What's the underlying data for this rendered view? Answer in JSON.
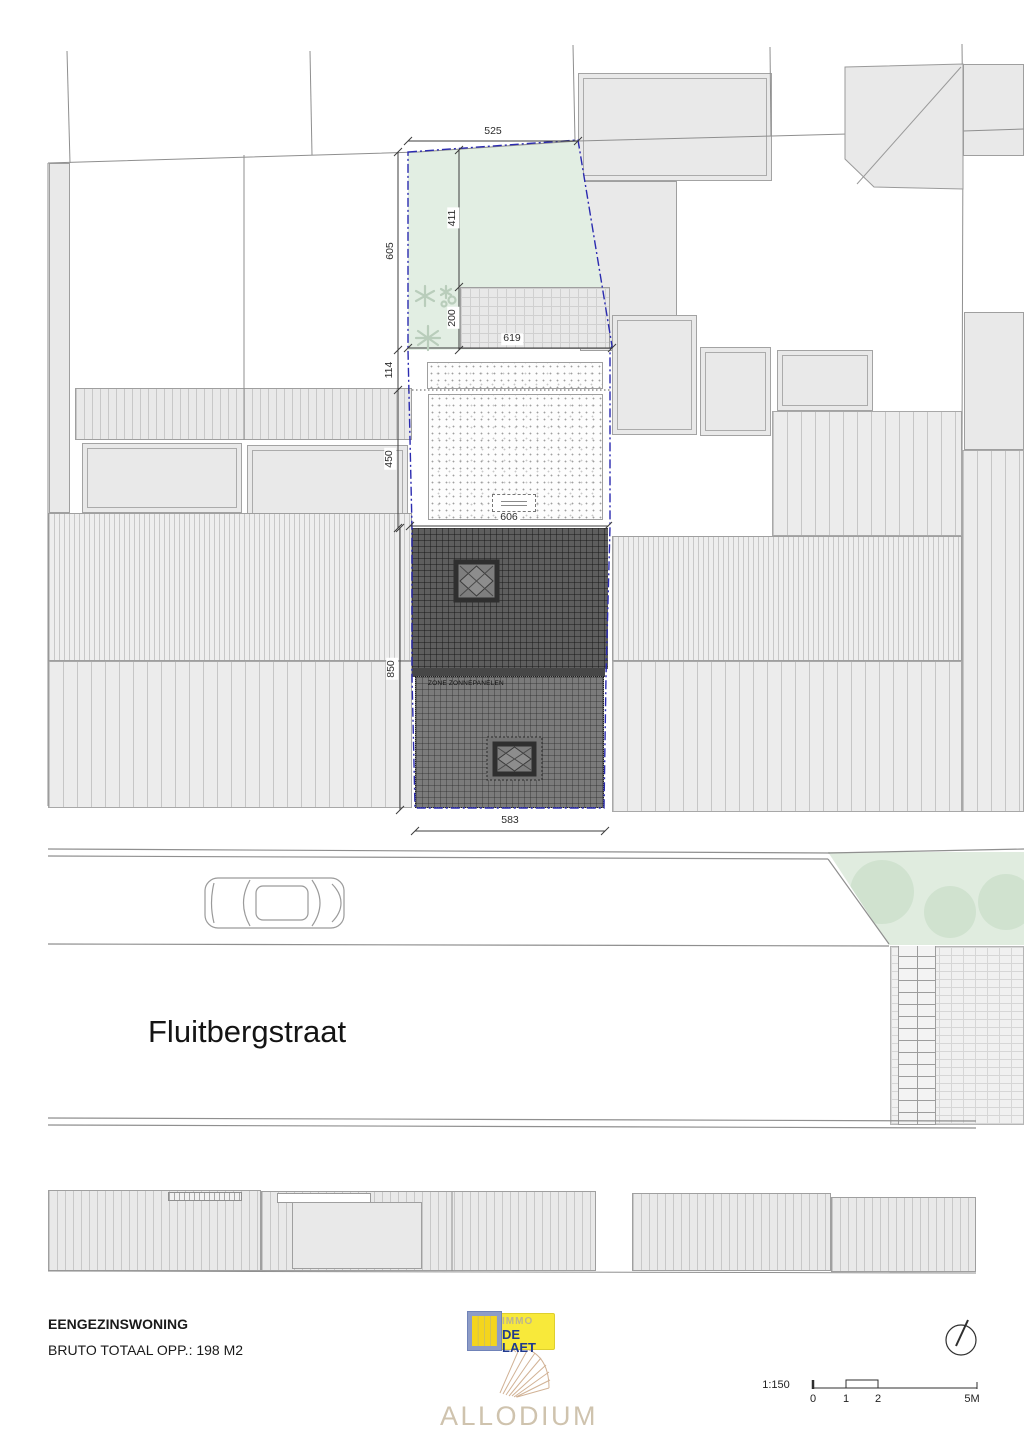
{
  "plan": {
    "street_name": "Fluitbergstraat",
    "solar_zone_label": "ZONE ZONNEPANELEN",
    "dimensions": {
      "garden_width_top": "525",
      "garden_height_left": "605",
      "garden_inner_height": "411",
      "terrace_height": "200",
      "width_at_terrace": "619",
      "setback_strip": "114",
      "main_roof_depth": "450",
      "main_roof_width": "606",
      "rear_building_depth": "850",
      "street_facade_width": "583"
    }
  },
  "footer": {
    "title": "EENGEZINSWONING",
    "subtitle": "BRUTO TOTAAL OPP.: 198 M2"
  },
  "logo": {
    "immo": "IMMO",
    "de_laet": "DE LAET",
    "allodium": "ALLODIUM"
  },
  "scalebar": {
    "ratio": "1:150",
    "ticks": [
      "0",
      "1",
      "2",
      "5M"
    ]
  },
  "colors": {
    "boundary_blue": "#2b2bb0",
    "garden_green": "#e2eee3",
    "dark_roof": "#5e5e5e",
    "logo_yellow": "#f8e93a",
    "logo_blue": "#8d9cc7"
  }
}
